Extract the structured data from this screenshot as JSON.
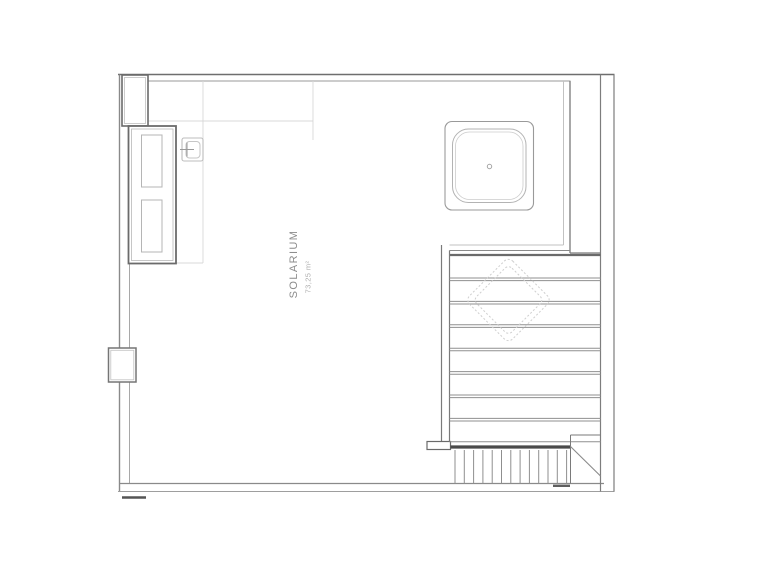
{
  "room_label": {
    "name": "SOLARIUM",
    "area": "73,25 m²"
  },
  "palette": {
    "background": "#ffffff",
    "wall_dark": "#5a5a5a",
    "wall_mid": "#7d7d7d",
    "line_light": "#b5b5b5",
    "line_faint": "#d8d8d8",
    "hatch_line": "#8f8f8f",
    "label_text": "#8c8c8c",
    "area_text": "#b0b0b0"
  },
  "symbols": {
    "drain_icon": "small-circle",
    "wall_fixture_icon": "plus-in-square",
    "skylight_icon": "dashed-rotated-square",
    "grate_icon": "vertical-hatch-strip"
  }
}
